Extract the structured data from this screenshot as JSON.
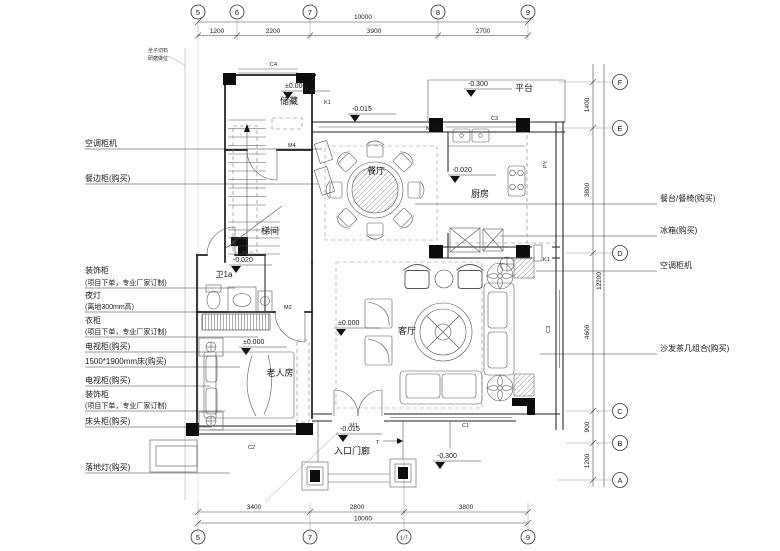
{
  "grid_top": {
    "total": "10000",
    "segs": [
      "1200",
      "2200",
      "3900",
      "2700"
    ],
    "bubbles": [
      "5",
      "6",
      "7",
      "8",
      "9"
    ]
  },
  "grid_bottom": {
    "total": "10000",
    "segs": [
      "3400",
      "2800",
      "3800"
    ],
    "bubbles": [
      "5",
      "7",
      "1/7",
      "9"
    ]
  },
  "grid_right": {
    "total": "12200",
    "segs": [
      "1400",
      "3800",
      "4600",
      "900",
      "1200"
    ],
    "bubbles": [
      "F",
      "E",
      "D",
      "C",
      "B",
      "A"
    ]
  },
  "rooms": {
    "storage": "储藏",
    "platform": "平台",
    "dining": "餐厅",
    "kitchen": "厨房",
    "stair": "梯间",
    "bath": "卫1a",
    "living": "客厅",
    "elder": "老人房",
    "porch": "入口门廊"
  },
  "levels": {
    "storage": "±0.000",
    "platform": "-0.300",
    "dining": "-0.015",
    "kitchen": "-0.020",
    "hall": "-0.020",
    "living": "±0.000",
    "elder": "±0.000",
    "porch": "-0.015",
    "outside": "-0.300"
  },
  "codes": {
    "c4": "C4",
    "k1_top": "K1",
    "mc1": "MC1",
    "c3_top": "C3",
    "py": "PY",
    "m4": "M4",
    "m2": "M2",
    "m1": "M1",
    "c1": "C1",
    "c2": "C2",
    "c3_right": "C3",
    "k1_right": "K1",
    "t": "T"
  },
  "left_labels": [
    {
      "text": "空调柜机",
      "sub": ""
    },
    {
      "text": "餐边柜(购买)",
      "sub": ""
    },
    {
      "text": "装饰柜",
      "sub": "(项目下单，专业厂家订制)"
    },
    {
      "text": "夜灯",
      "sub": "(离地300mm高)"
    },
    {
      "text": "衣柜",
      "sub": "(项目下单，专业厂家订制)"
    },
    {
      "text": "电视柜(购买)",
      "sub": ""
    },
    {
      "text": "1500*1900mm床(购买)",
      "sub": ""
    },
    {
      "text": "电视柜(购买)",
      "sub": ""
    },
    {
      "text": "装饰柜",
      "sub": "(项目下单，专业厂家订制)"
    },
    {
      "text": "床头柜(购买)",
      "sub": ""
    },
    {
      "text": "落地灯(购买)",
      "sub": ""
    }
  ],
  "right_labels": [
    {
      "text": "餐台/餐椅(购买)"
    },
    {
      "text": "冰箱(购买)"
    },
    {
      "text": "空调柜机"
    },
    {
      "text": "沙发茶几组合(购买)"
    }
  ],
  "notes": {
    "line1": "全子切石",
    "line2": "研磨做位"
  }
}
